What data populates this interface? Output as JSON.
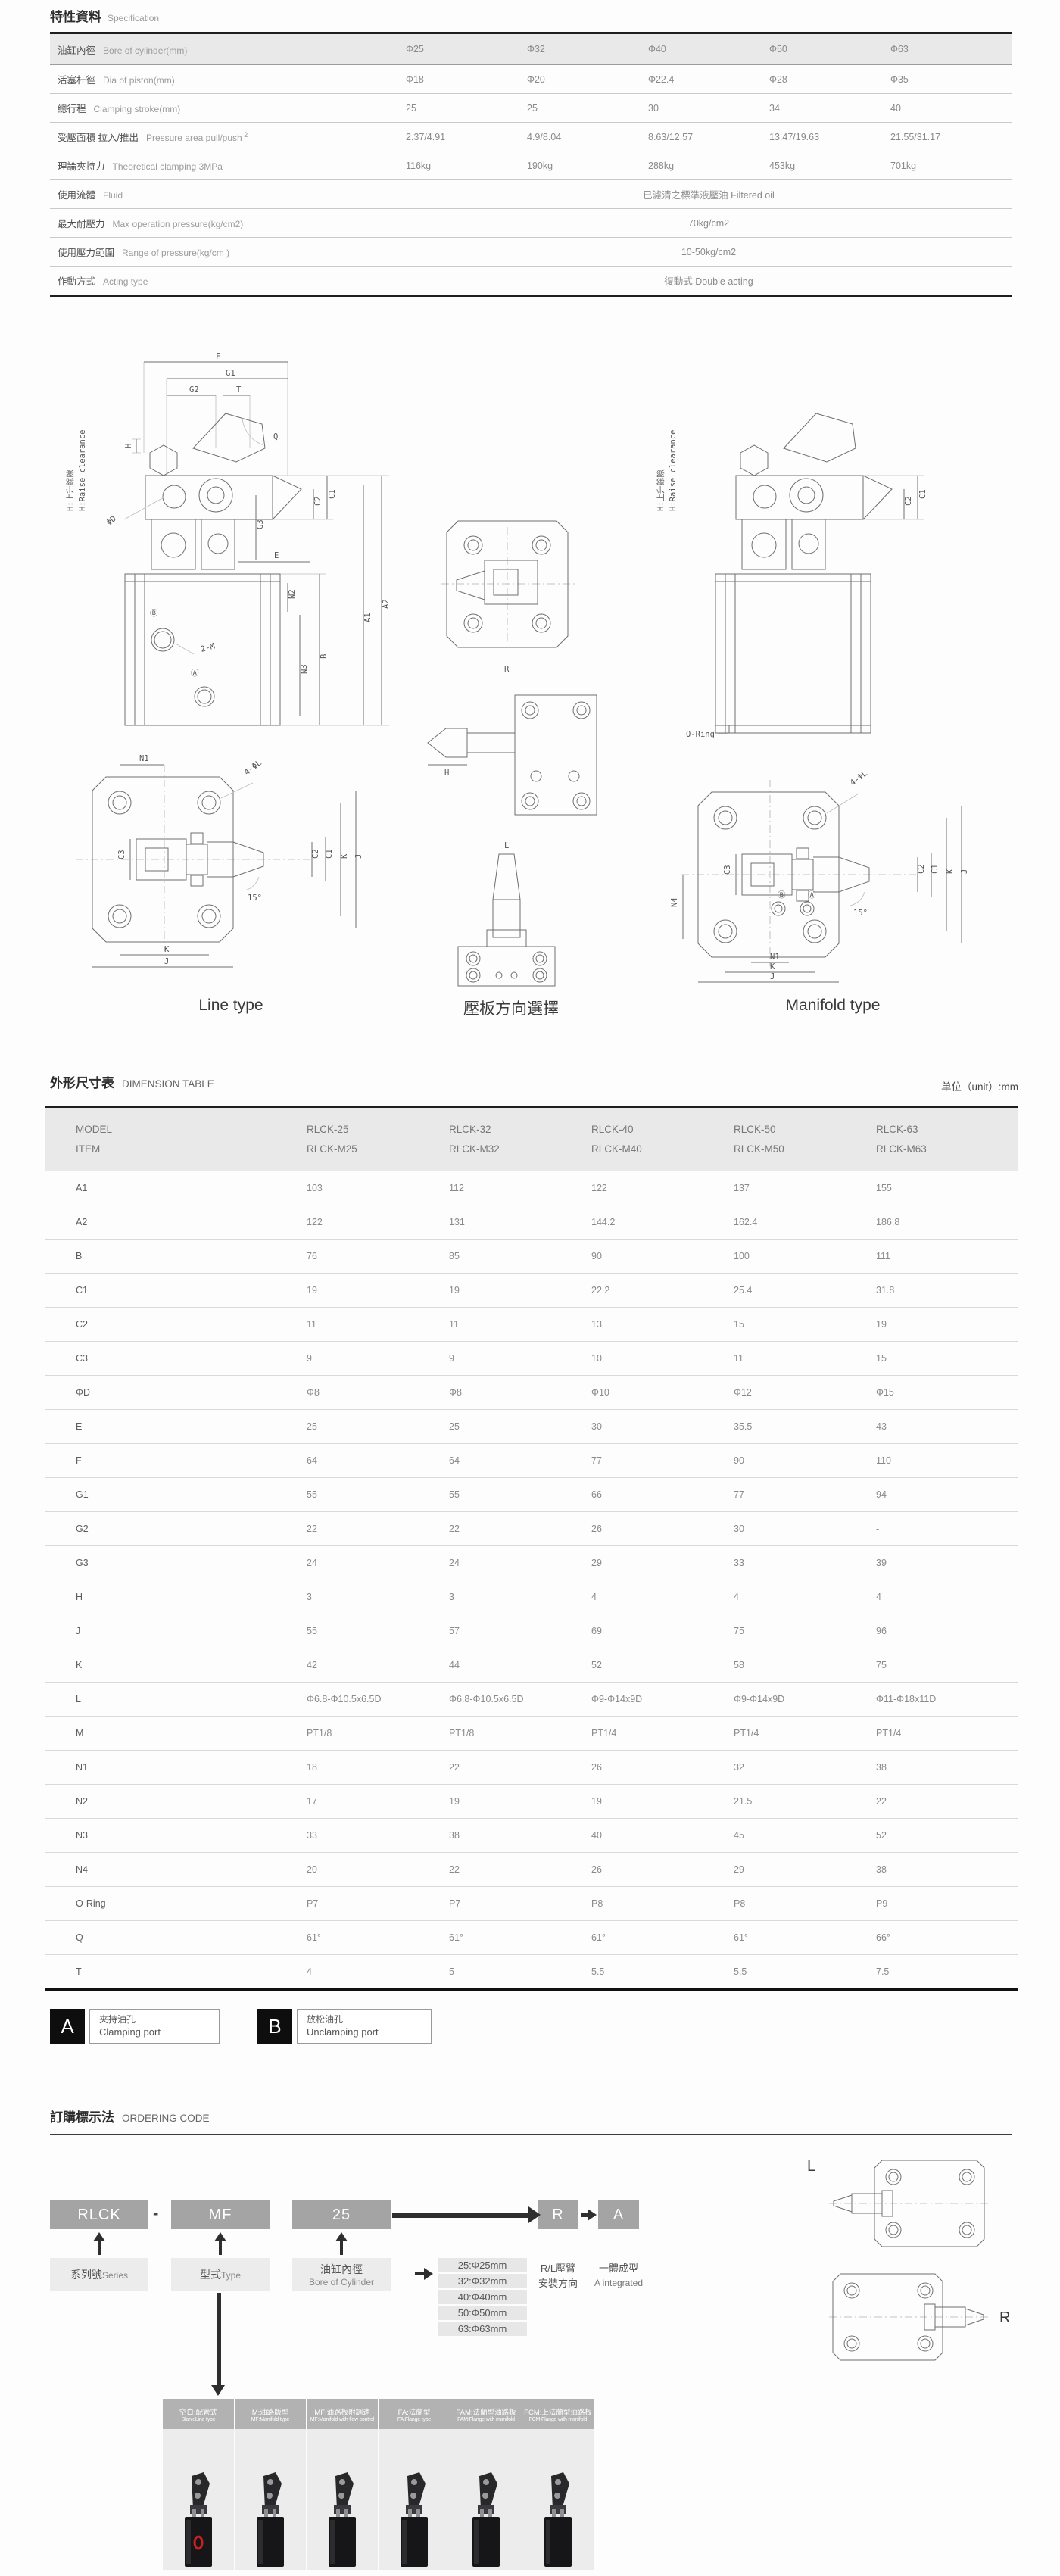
{
  "spec": {
    "title_zh": "特性資料",
    "title_en": "Specification",
    "rows": [
      {
        "zh": "油缸內徑",
        "en": "Bore of cylinder(mm)",
        "values": [
          "Φ25",
          "Φ32",
          "Φ40",
          "Φ50",
          "Φ63"
        ],
        "shaded": true
      },
      {
        "zh": "活塞杆徑",
        "en": "Dia of piston(mm)",
        "values": [
          "Φ18",
          "Φ20",
          "Φ22.4",
          "Φ28",
          "Φ35"
        ]
      },
      {
        "zh": "總行程",
        "en": "Clamping stroke(mm)",
        "values": [
          "25",
          "25",
          "30",
          "34",
          "40"
        ]
      },
      {
        "zh": "受壓面積 拉入/推出",
        "en": "Pressure area pull/push",
        "sup": "2",
        "values": [
          "2.37/4.91",
          "4.9/8.04",
          "8.63/12.57",
          "13.47/19.63",
          "21.55/31.17"
        ]
      },
      {
        "zh": "理論夾持力",
        "en": "Theoretical clamping 3MPa",
        "values": [
          "116kg",
          "190kg",
          "288kg",
          "453kg",
          "701kg"
        ]
      },
      {
        "zh": "使用流體",
        "en": "Fluid",
        "span": "已濾清之標準液壓油 Filtered oil"
      },
      {
        "zh": "最大耐壓力",
        "en": "Max operation pressure(kg/cm2)",
        "span": "70kg/cm2"
      },
      {
        "zh": "使用壓力範圍",
        "en": "Range of pressure(kg/cm )",
        "span": "10-50kg/cm2"
      },
      {
        "zh": "作動方式",
        "en": "Acting type",
        "span": "復動式 Double acting"
      }
    ]
  },
  "drawings": {
    "captions": {
      "left": "Line type",
      "middle": "壓板方向選擇",
      "right": "Manifold type"
    },
    "dim_labels": {
      "d1": [
        "F",
        "G1",
        "G2",
        "T",
        "Q",
        "H",
        "ΦD",
        "C1",
        "C2",
        "G3",
        "E",
        "A1",
        "A2",
        "B",
        "N3",
        "N2",
        "2-M",
        "Ⓑ",
        "Ⓐ",
        "H:上升餘隙",
        "H:Raise clearance"
      ],
      "d2": [
        "N1",
        "4-ΦL",
        "C3",
        "C2",
        "C1",
        "K",
        "J",
        "15°",
        "K",
        "J"
      ],
      "d3": [
        "R",
        "H",
        "L"
      ],
      "d4": [
        "O-Ring",
        "H:上升餘隙",
        "H:Raise clearance",
        "C1",
        "C2"
      ],
      "d5": [
        "4-ΦL",
        "C3",
        "C2",
        "C1",
        "K",
        "J",
        "15°",
        "N4",
        "Ⓑ",
        "Ⓐ",
        "N1",
        "K",
        "J"
      ]
    }
  },
  "dimension_table": {
    "title_zh": "外形尺寸表",
    "title_en": "DIMENSION TABLE",
    "unit": "单位（unit）:mm",
    "header_line1": "MODEL",
    "header_line2": "ITEM",
    "models": [
      [
        "RLCK-25",
        "RLCK-M25"
      ],
      [
        "RLCK-32",
        "RLCK-M32"
      ],
      [
        "RLCK-40",
        "RLCK-M40"
      ],
      [
        "RLCK-50",
        "RLCK-M50"
      ],
      [
        "RLCK-63",
        "RLCK-M63"
      ]
    ],
    "rows": [
      {
        "item": "A1",
        "values": [
          "103",
          "112",
          "122",
          "137",
          "155"
        ]
      },
      {
        "item": "A2",
        "values": [
          "122",
          "131",
          "144.2",
          "162.4",
          "186.8"
        ]
      },
      {
        "item": "B",
        "values": [
          "76",
          "85",
          "90",
          "100",
          "111"
        ]
      },
      {
        "item": "C1",
        "values": [
          "19",
          "19",
          "22.2",
          "25.4",
          "31.8"
        ]
      },
      {
        "item": "C2",
        "values": [
          "11",
          "11",
          "13",
          "15",
          "19"
        ]
      },
      {
        "item": "C3",
        "values": [
          "9",
          "9",
          "10",
          "11",
          "15"
        ]
      },
      {
        "item": "ΦD",
        "values": [
          "Φ8",
          "Φ8",
          "Φ10",
          "Φ12",
          "Φ15"
        ]
      },
      {
        "item": "E",
        "values": [
          "25",
          "25",
          "30",
          "35.5",
          "43"
        ]
      },
      {
        "item": "F",
        "values": [
          "64",
          "64",
          "77",
          "90",
          "110"
        ]
      },
      {
        "item": "G1",
        "values": [
          "55",
          "55",
          "66",
          "77",
          "94"
        ]
      },
      {
        "item": "G2",
        "values": [
          "22",
          "22",
          "26",
          "30",
          "-"
        ]
      },
      {
        "item": "G3",
        "values": [
          "24",
          "24",
          "29",
          "33",
          "39"
        ]
      },
      {
        "item": "H",
        "values": [
          "3",
          "3",
          "4",
          "4",
          "4"
        ]
      },
      {
        "item": "J",
        "values": [
          "55",
          "57",
          "69",
          "75",
          "96"
        ]
      },
      {
        "item": "K",
        "values": [
          "42",
          "44",
          "52",
          "58",
          "75"
        ]
      },
      {
        "item": "L",
        "values": [
          "Φ6.8-Φ10.5x6.5D",
          "Φ6.8-Φ10.5x6.5D",
          "Φ9-Φ14x9D",
          "Φ9-Φ14x9D",
          "Φ11-Φ18x11D"
        ]
      },
      {
        "item": "M",
        "values": [
          "PT1/8",
          "PT1/8",
          "PT1/4",
          "PT1/4",
          "PT1/4"
        ]
      },
      {
        "item": "N1",
        "values": [
          "18",
          "22",
          "26",
          "32",
          "38"
        ]
      },
      {
        "item": "N2",
        "values": [
          "17",
          "19",
          "19",
          "21.5",
          "22"
        ]
      },
      {
        "item": "N3",
        "values": [
          "33",
          "38",
          "40",
          "45",
          "52"
        ]
      },
      {
        "item": "N4",
        "values": [
          "20",
          "22",
          "26",
          "29",
          "38"
        ]
      },
      {
        "item": "O-Ring",
        "values": [
          "P7",
          "P7",
          "P8",
          "P8",
          "P9"
        ]
      },
      {
        "item": "Q",
        "values": [
          "61°",
          "61°",
          "61°",
          "61°",
          "66°"
        ]
      },
      {
        "item": "T",
        "values": [
          "4",
          "5",
          "5.5",
          "5.5",
          "7.5"
        ]
      }
    ]
  },
  "legend": {
    "a_key": "A",
    "a_zh": "夹持油孔",
    "a_en": "Clamping port",
    "b_key": "B",
    "b_zh": "放松油孔",
    "b_en": "Unclamping port"
  },
  "ordering": {
    "title_zh": "訂購標示法",
    "title_en": "ORDERING CODE",
    "dash": "-",
    "boxes": {
      "series": "RLCK",
      "type": "MF",
      "bore": "25",
      "direction": "R",
      "integrated": "A"
    },
    "series_zh": "系列號",
    "series_en": "Series",
    "type_zh": "型式",
    "type_en": "Type",
    "bore_zh": "油缸內徑",
    "bore_en": "Bore of Cylinder",
    "bore_options": [
      "25:Φ25mm",
      "32:Φ32mm",
      "40:Φ40mm",
      "50:Φ50mm",
      "63:Φ63mm"
    ],
    "direction_zh": "R/L壓臂",
    "direction_zh2": "安裝方向",
    "integrated_zh": "一體成型",
    "integrated_en": "A integrated",
    "lr_labels": [
      "L",
      "R"
    ],
    "products": [
      {
        "zh": "空白:配管式",
        "en": "Blank:Line type"
      },
      {
        "zh": "M:油路版型",
        "en": "MF:Manifold type"
      },
      {
        "zh": "MF:油路板附調速",
        "en": "MF:Manifold with flow control"
      },
      {
        "zh": "FA:法蘭型",
        "en": "FA:Flange type"
      },
      {
        "zh": "FAM:法蘭型油路板",
        "en": "FAM:Flange with manifold"
      },
      {
        "zh": "FCM:上法蘭型油路板",
        "en": "FCM:Flange with manifold"
      }
    ]
  }
}
